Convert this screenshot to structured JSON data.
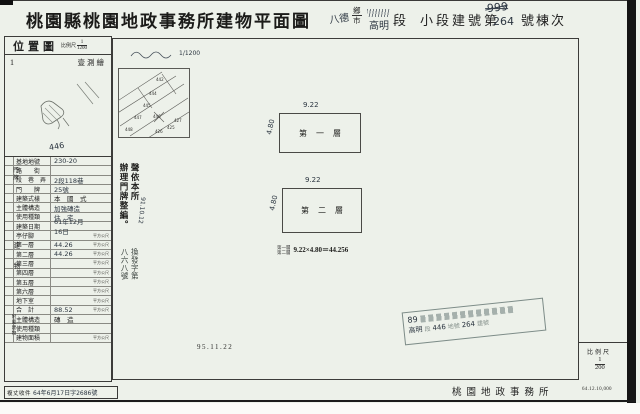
{
  "header": {
    "title": "桃園縣桃園地政事務所建物平面圖",
    "township_hw": "八德",
    "unit_top": "鄉",
    "unit_bottom": "市",
    "section_hw": "高明",
    "section_label": "段",
    "subsection_label": "小段建號第",
    "building_no_old": "999",
    "building_no": "264",
    "suffix_label": "號棟次"
  },
  "sidebar": {
    "map": {
      "title": "位置圖",
      "scale_label": "比例尺",
      "scale_num": "1",
      "scale_den": "1200",
      "corner_no": "1",
      "note": "壹測繪",
      "parcel_hw": "446"
    },
    "groups": {
      "doorplate": "門牌",
      "area": "建物",
      "annex": "附屬建物"
    },
    "rows": [
      {
        "l": "基地地號",
        "v": "230-20",
        "u": "",
        "hw": true
      },
      {
        "l": "路　　街",
        "v": "",
        "u": ""
      },
      {
        "l": "段　巷　弄",
        "v": "2段118巷",
        "u": "",
        "hw": true
      },
      {
        "l": "門　　牌",
        "v": "25號",
        "u": "",
        "hw": true
      },
      {
        "l": "建築式樣",
        "v": "本　國　式",
        "u": ""
      },
      {
        "l": "主體構造",
        "v": "加強磚造",
        "u": "",
        "hw": true
      },
      {
        "l": "使用種類",
        "v": "住　宅",
        "u": "",
        "hw": true
      },
      {
        "l": "建築日期",
        "v": "61年12月16日",
        "u": "",
        "hw": true
      },
      {
        "l": "亭仔腳",
        "v": "",
        "u": "平方公尺"
      },
      {
        "l": "第一層",
        "v": "44.26",
        "u": "平方公尺",
        "hw": true
      },
      {
        "l": "第二層",
        "v": "44.26",
        "u": "平方公尺",
        "hw": true
      },
      {
        "l": "第三層",
        "v": "",
        "u": "平方公尺"
      },
      {
        "l": "第四層",
        "v": "",
        "u": "平方公尺"
      },
      {
        "l": "第五層",
        "v": "",
        "u": "平方公尺"
      },
      {
        "l": "第六層",
        "v": "",
        "u": "平方公尺"
      },
      {
        "l": "地下室",
        "v": "",
        "u": "平方公尺"
      },
      {
        "l": "合　計",
        "v": "88.52",
        "u": "平方公尺",
        "hw": true
      },
      {
        "l": "主體構造",
        "v": "磚　造",
        "u": ""
      },
      {
        "l": "使用種類",
        "v": "",
        "u": ""
      },
      {
        "l": "建物面積",
        "v": "",
        "u": "平方公尺"
      }
    ],
    "survey": {
      "label": "複丈收件",
      "value": "64年6月17日字2686號"
    }
  },
  "main": {
    "note_scale_hw": "1/1200",
    "parcels": [
      "442",
      "444",
      "445",
      "447",
      "448",
      "446",
      "425",
      "426",
      "427"
    ],
    "annot1_col1": "聲依本所",
    "annot1_col2": "辦理門牌整編。",
    "annot1_date_hw": "91.10.12",
    "annot2_col1": "換發字第",
    "annot2_col2": "八六八號",
    "floor1": {
      "label": "第一層",
      "w": "9.22",
      "h": "4.80"
    },
    "floor2": {
      "label": "第二層",
      "w": "9.22",
      "h": "4.80"
    },
    "formula": {
      "top": "第一層",
      "bottom": "第二層",
      "calc": "9.22×4.80＝44.256"
    },
    "date": "95.11.22",
    "stamp": {
      "year_hw": "89",
      "seg_hw": "高明",
      "seg": "段",
      "parcel_hw": "446",
      "parcel": "地號",
      "bldg_hw": "264",
      "bldg": "建號"
    }
  },
  "footer": {
    "scale_label": "比例尺",
    "scale_num": "1",
    "scale_den": "200",
    "office": "桃園地政事務所",
    "print_code": "64.12.10,000"
  }
}
